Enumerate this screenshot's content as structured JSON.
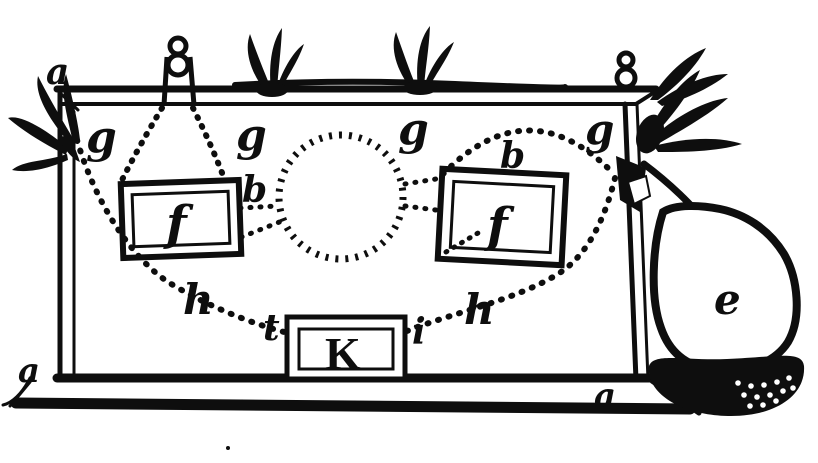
{
  "palette": {
    "ink": "#0e0e0e",
    "paper": "#ffffff"
  },
  "figure": {
    "kind": "antique-engraving-diagram"
  },
  "labels": {
    "corner_top_left": "a",
    "post_left": "g",
    "rail_left": "g",
    "rail_right": "g",
    "post_right": "g",
    "junction_left": "b",
    "arc_top": "b",
    "plate_left": "f",
    "plate_right": "f",
    "chain_left": "h",
    "chain_right": "h",
    "key_left": "t",
    "key_right": "i",
    "key_box": "K",
    "corner_bottom_left": "a",
    "base_right": "a",
    "flask_bulb": "e"
  }
}
